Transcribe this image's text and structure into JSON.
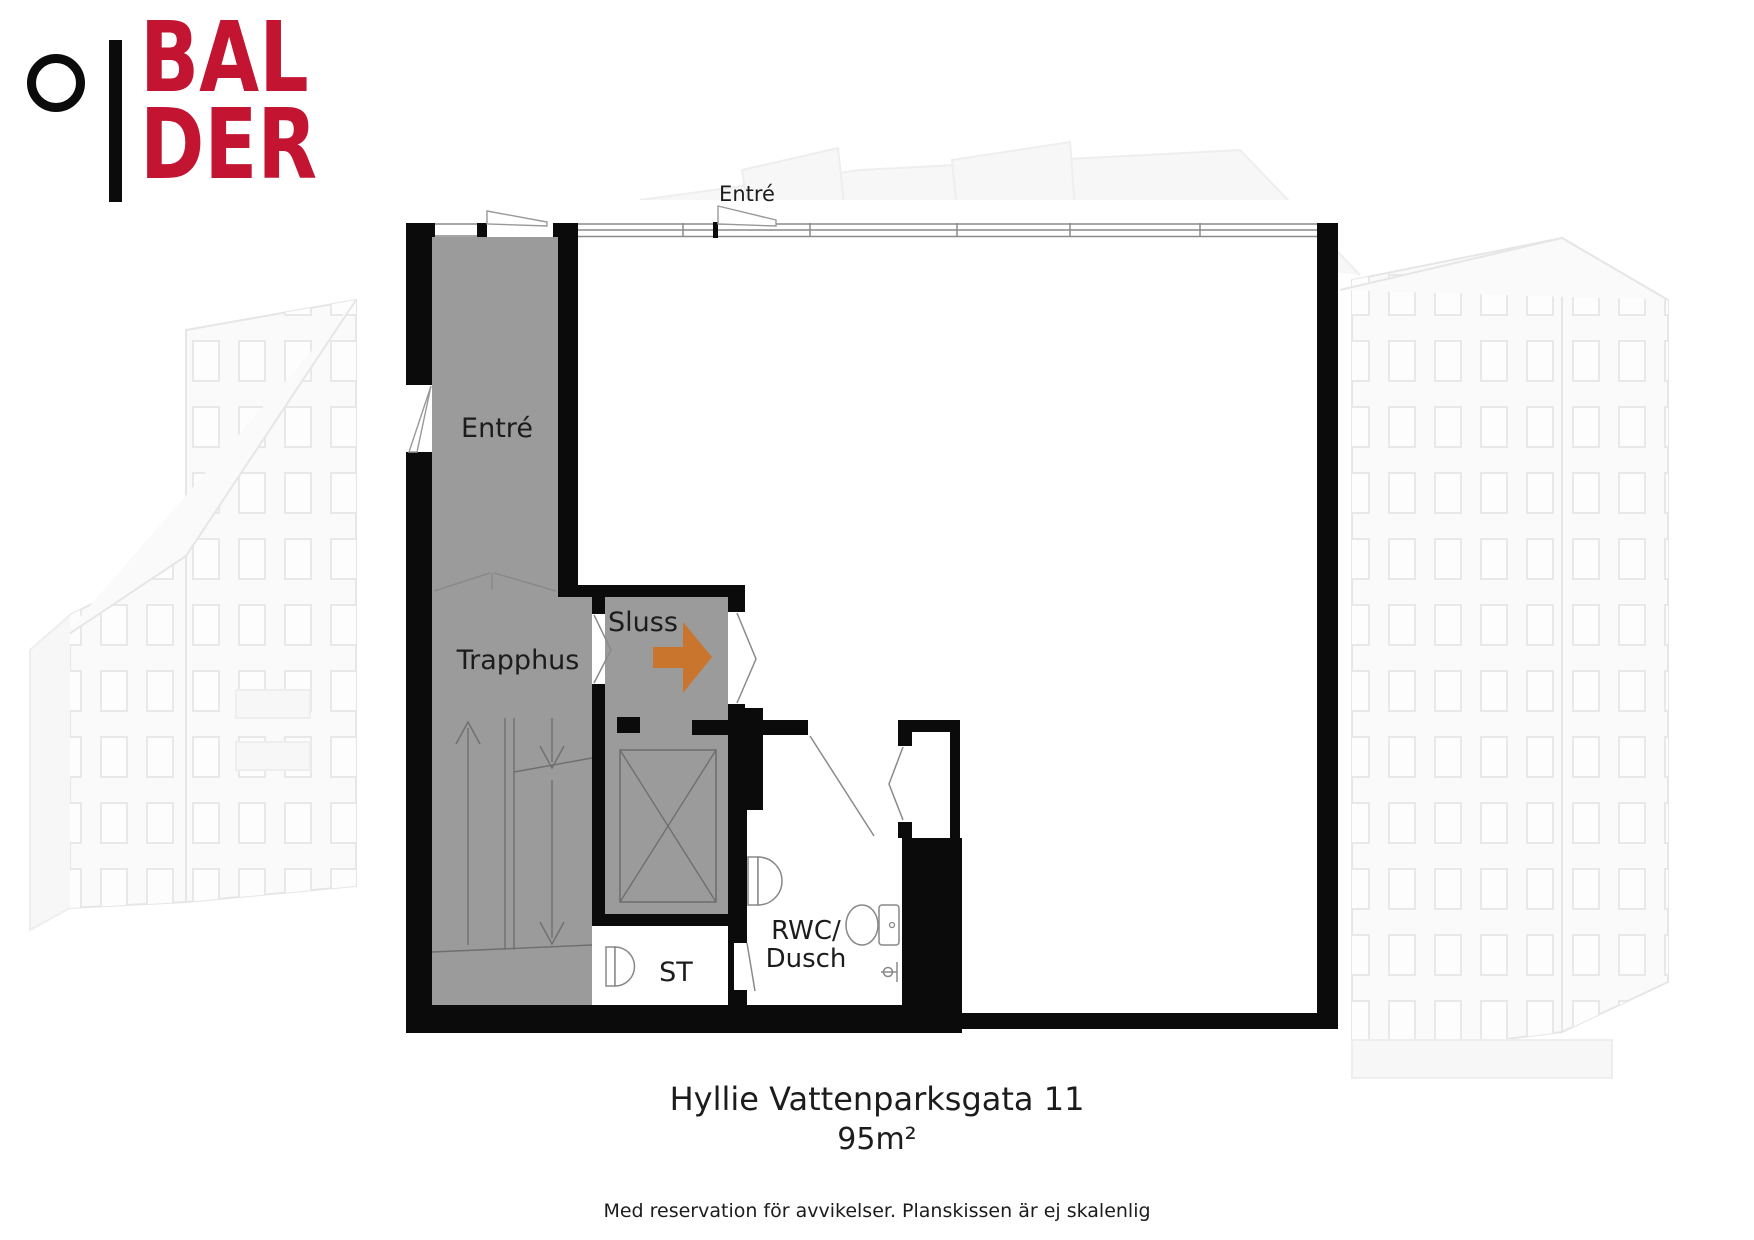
{
  "logo": {
    "line1": "BAL",
    "line2": "DER",
    "brand_color": "#c31432"
  },
  "plan": {
    "labels": {
      "entre_top": "Entré",
      "entre_hall": "Entré",
      "trapphus": "Trapphus",
      "sluss": "Sluss",
      "st": "ST",
      "rwc_line1": "RWC/",
      "rwc_line2": "Dusch"
    },
    "colors": {
      "wall": "#0b0b0b",
      "room_gray": "#9b9b9b",
      "arrow_orange": "#c9752e"
    }
  },
  "footer": {
    "address": "Hyllie Vattenparksgata 11",
    "area": "95m²",
    "disclaimer": "Med reservation för avvikelser. Planskissen är ej skalenlig"
  }
}
